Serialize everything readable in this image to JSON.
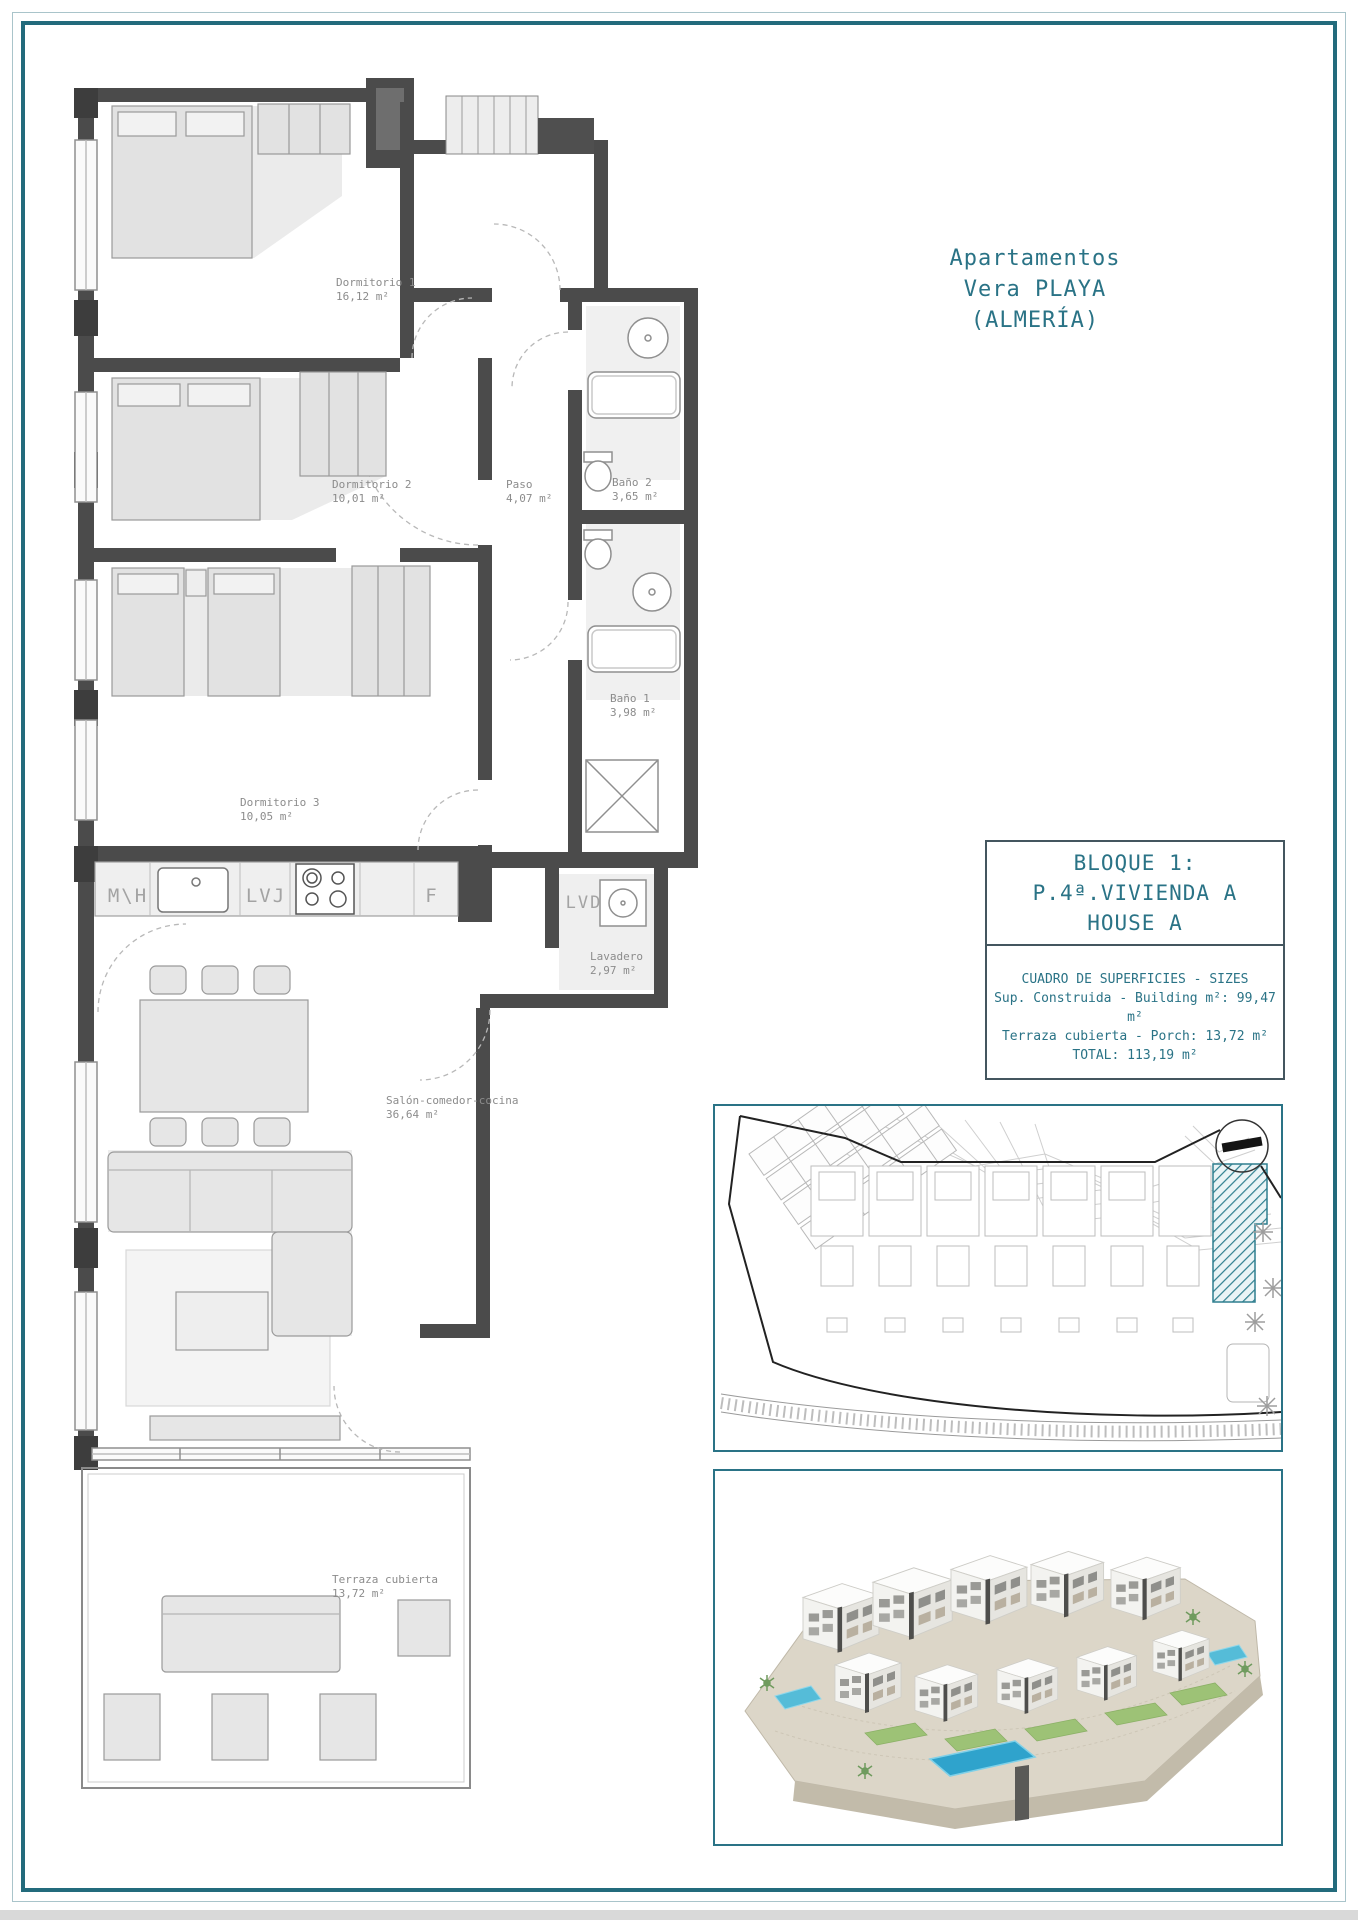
{
  "colors": {
    "accent_teal": "#2a7386",
    "frame_teal": "#236b7c",
    "hatch_teal": "#2f7f8f",
    "wall_gray": "#4b4b4b",
    "label_gray": "#8c8c8c"
  },
  "title": {
    "line1": "Apartamentos",
    "line2": "Vera PLAYA",
    "line3": "(ALMERÍA)"
  },
  "info_box": {
    "line1": "BLOQUE 1:",
    "line2": "P.4ª.VIVIENDA A",
    "line3": "HOUSE A",
    "sizes_title": "CUADRO DE SUPERFICIES  - SIZES",
    "size_row1": "Sup. Construida  - Building m²: 99,47 m²",
    "size_row2": "Terraza cubierta  - Porch: 13,72 m²",
    "size_row3": "TOTAL:  113,19 m²"
  },
  "rooms": {
    "dormitorio1": {
      "name": "Dormitorio 1",
      "area": "16,12 m²"
    },
    "dormitorio2": {
      "name": "Dormitorio 2",
      "area": "10,01 m²"
    },
    "paso": {
      "name": "Paso",
      "area": "4,07 m²"
    },
    "bano2": {
      "name": "Baño 2",
      "area": "3,65 m²"
    },
    "bano1": {
      "name": "Baño 1",
      "area": "3,98 m²"
    },
    "dormitorio3": {
      "name": "Dormitorio 3",
      "area": "10,05 m²"
    },
    "lavadero": {
      "name": "Lavadero",
      "area": "2,97 m²"
    },
    "salon": {
      "name": "Salón-comedor-cocina",
      "area": "36,64 m²"
    },
    "terraza": {
      "name": "Terraza cubierta",
      "area": "13,72 m²"
    }
  },
  "kitchen": {
    "mvh": "M\\H",
    "lvj": "LVJ",
    "f": "F",
    "lvd": "LVD"
  }
}
